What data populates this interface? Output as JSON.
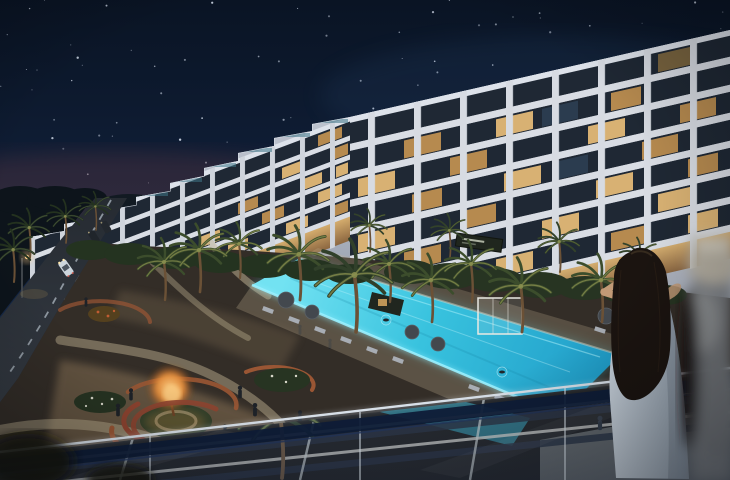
{
  "meta": {
    "width": 730,
    "height": 480,
    "type": "night architectural rendering, no legible text"
  },
  "scene": {
    "description": "Night aerial rendering of a white U-shaped luxury residential complex with lit floor-to-ceiling windows, a long glowing turquoise glass-walled pool, illuminated palm gardens with a fire-lit tree plaza and curved terracotta benches, a palm-lined street with cars on the left, viewed from a balcony with a glass railing where a long-haired woman in a light dress photographs the view",
    "sky": {
      "label": "starry night sky",
      "star_count": 95
    },
    "building": {
      "label": "white residential complex",
      "right_wing_floors": 8,
      "terraced_wing_steps": 8,
      "sign": {
        "label": "dark awning sign on facade",
        "text_legible": false
      }
    },
    "pool": {
      "label": "elevated glass-walled lap pool",
      "swimmers": 2
    },
    "garden": {
      "label": "landscaped courtyard",
      "features": [
        "palm trees",
        "fire-lit tree plaza",
        "curved terracotta benches",
        "winding footpaths",
        "sun loungers",
        "umbrellas",
        "white cabana",
        "dark cabana"
      ]
    },
    "street": {
      "label": "palm-lined street",
      "cars": 4,
      "lane_marking": "dashed centerline",
      "street_lamp": true
    },
    "foreground": {
      "label": "balcony viewpoint",
      "elements": [
        "glass railing",
        "dark handrail band",
        "pergola deck below",
        "woman with long dark hair in light dress",
        "blurred object at right edge"
      ]
    }
  },
  "colors": {
    "skyTop": "#0a1424",
    "skyMid": "#122340",
    "skyLow": "#1d3356",
    "star": "#d7e0ee",
    "glowWarm": "#6b3a42",
    "cityGlow": "#2c4a6e",
    "treeline": "#0d141b",
    "facade": "#c7ccd6",
    "facadeHi": "#dde2ea",
    "slab": "#d9dde4",
    "windowRow": "#1f2834",
    "windowLitA": "#e8bd78",
    "windowLitB": "#c69552",
    "windowDim": "#8a6f42",
    "windowCool": "#2c3e52",
    "arcadeHi": "#d8ac66",
    "arcadeLo": "#8a6136",
    "balustrade": "#3e7586",
    "sign": "#20261e",
    "ground": "#332d27",
    "groundWarm": "#8a7356",
    "path": "#c6b897",
    "terracotta": "#9a5634",
    "benchRed": "#8e4430",
    "lawn": "#33402a",
    "fireCore": "#f8c87e",
    "fireMid": "#e08a3a",
    "shrub": "#273422",
    "bloom": "#d8d8ca",
    "poolA": "#72e2f2",
    "poolB": "#38c2de",
    "poolC": "#1f9cc8",
    "poolEdge": "#9af0ff",
    "deck": "#b9a98c",
    "lounger": "#a8adb4",
    "umbrella": "#43484e",
    "cabana": "#e9e9e3",
    "palmDark": "#24321f",
    "palmMid": "#3c4d2c",
    "palmLit": "#7c8448",
    "trunk": "#6b5136",
    "asphalt": "#343a42",
    "asphaltDark": "#262b32",
    "dash": "#aeb8c2",
    "carWhite": "#ccd5dc",
    "carDark": "#262b31",
    "headlight": "#ffe9b0",
    "lampGlow": "#ffcf8a",
    "pergolaLight": "#d6d3ca",
    "pergolaDark": "#242a36",
    "railDark": "#0e1d38",
    "railEdge": "#23355a",
    "handrail": "#d5dde6",
    "hair": "#1b1410",
    "hairHi": "#4a3a28",
    "dressA": "#c6d0da",
    "dressB": "#93a0ad",
    "skin": "#c29a76",
    "blurGray": "#7c8084",
    "blurLight": "#b3ada0"
  }
}
